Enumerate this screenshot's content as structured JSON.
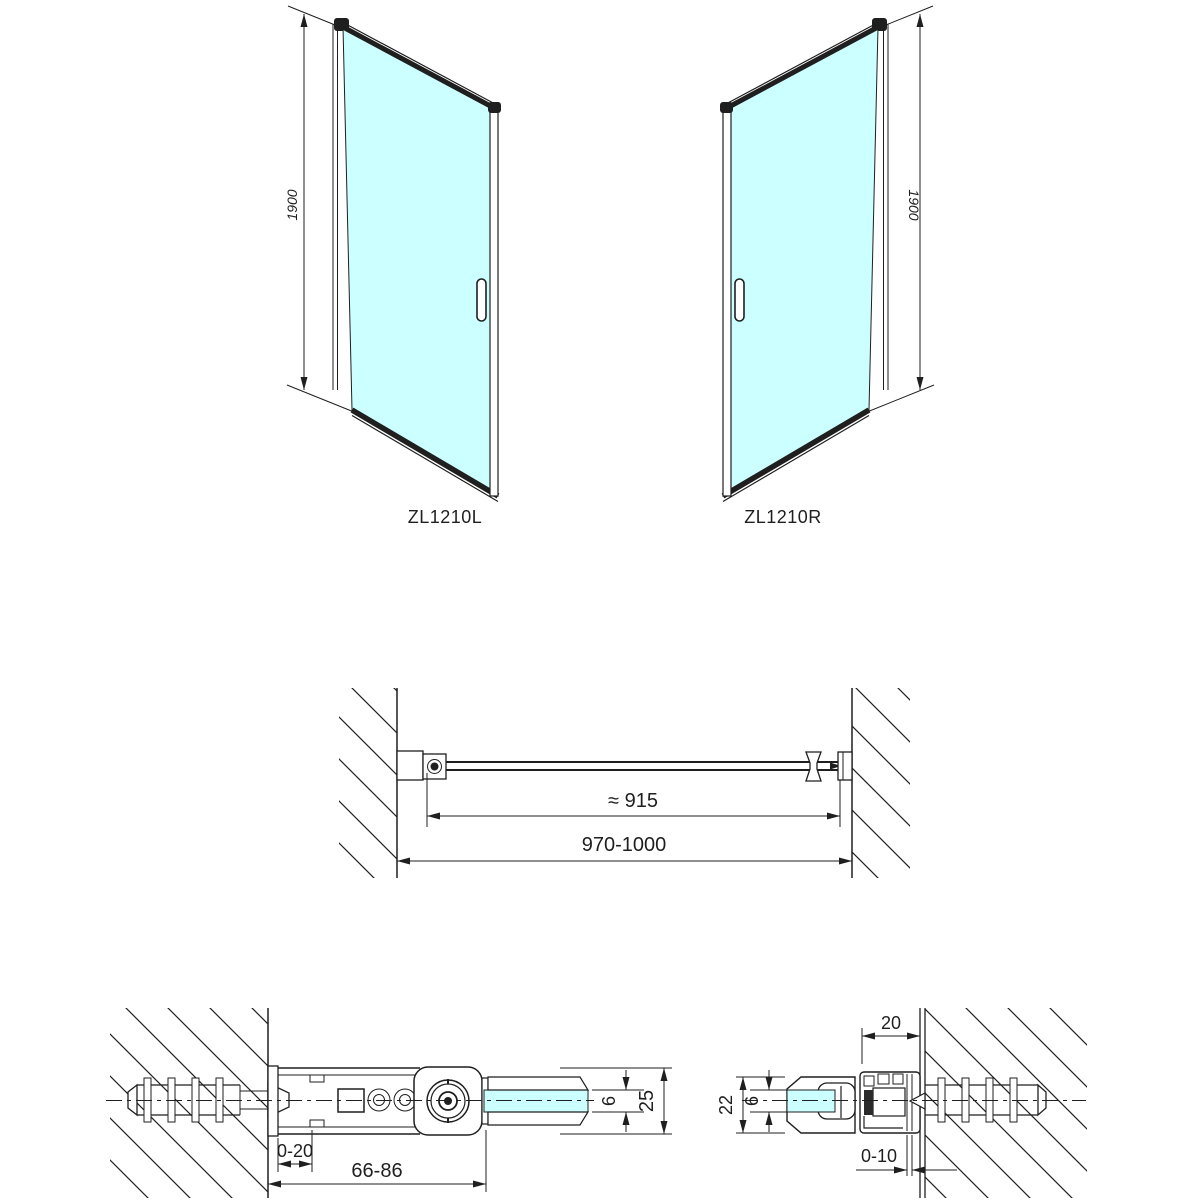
{
  "views": {
    "left_door": {
      "code": "ZL1210L",
      "height": "1900"
    },
    "right_door": {
      "code": "ZL1210R",
      "height": "1900"
    },
    "plan": {
      "glass_width": "≈ 915",
      "total_width": "970-1000"
    },
    "hinge_detail": {
      "wall_offset": "0-20",
      "hinge_depth": "66-86",
      "glass_thickness": "6",
      "profile_depth": "25"
    },
    "profile_detail": {
      "profile_width": "20",
      "profile_depth": "22",
      "glass_thickness": "6",
      "adjustment": "0-10"
    }
  },
  "colors": {
    "background": "#ffffff",
    "line": "#1f1f1f",
    "glass": "#ccffff"
  }
}
